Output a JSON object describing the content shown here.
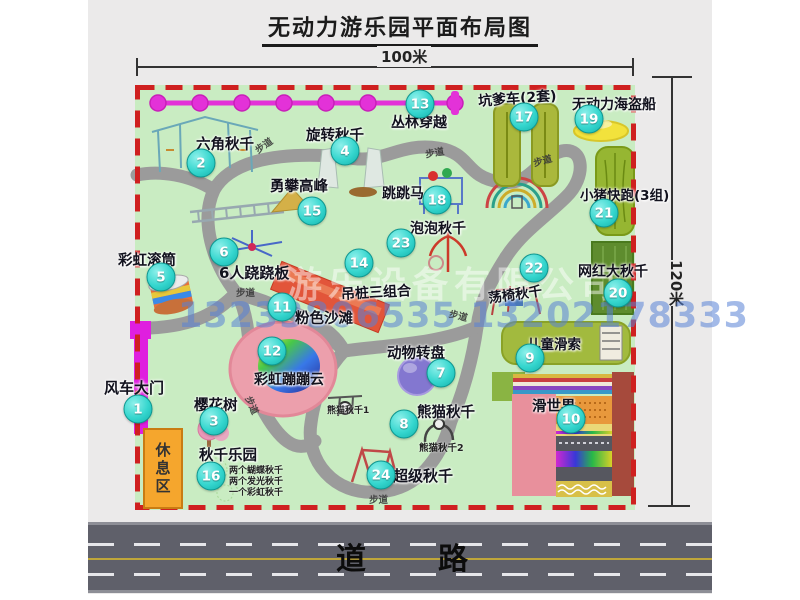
{
  "title": "无动力游乐园平面布局图",
  "dims": {
    "width": "100米",
    "height": "120米"
  },
  "road_label": "道路",
  "rest_area_label": "休息区",
  "watermark": {
    "company": "游乐设备有限公司",
    "phone": "13233806535 13202178333"
  },
  "notes": {
    "footpath": "步道",
    "panda1": "熊猫秋千1",
    "panda2": "熊猫秋千2",
    "swing_notes": [
      "两个蝴蝶秋千",
      "两个发光秋千",
      "一个彩虹秋千"
    ]
  },
  "attractions": [
    {
      "num": "1",
      "label": "风车大门"
    },
    {
      "num": "2",
      "label": "六角秋千"
    },
    {
      "num": "3",
      "label": "樱花树"
    },
    {
      "num": "4",
      "label": "旋转秋千"
    },
    {
      "num": "5",
      "label": "彩虹滚筒"
    },
    {
      "num": "6",
      "label": "6人跷跷板"
    },
    {
      "num": "7",
      "label": "动物转盘"
    },
    {
      "num": "8",
      "label": "熊猫秋千"
    },
    {
      "num": "9",
      "label": "儿童滑索"
    },
    {
      "num": "10",
      "label": "滑世界"
    },
    {
      "num": "11",
      "label": "粉色沙滩"
    },
    {
      "num": "12",
      "label": "彩虹蹦蹦云"
    },
    {
      "num": "13",
      "label": "丛林穿越"
    },
    {
      "num": "14",
      "label": "吊桩三组合"
    },
    {
      "num": "15",
      "label": "勇攀高峰"
    },
    {
      "num": "16",
      "label": "秋千乐园"
    },
    {
      "num": "17",
      "label": "坑爹车(2套)"
    },
    {
      "num": "18",
      "label": "跳跳马"
    },
    {
      "num": "19",
      "label": "无动力海盗船"
    },
    {
      "num": "20",
      "label": "网红大秋千"
    },
    {
      "num": "21",
      "label": "小猪快跑(3组)"
    },
    {
      "num": "22",
      "label": "荡椅秋千"
    },
    {
      "num": "23",
      "label": "泡泡秋千"
    },
    {
      "num": "24",
      "label": "超级秋千"
    }
  ],
  "colors": {
    "park_green": "#c9ecc2",
    "border_red": "#cf2020",
    "path_gray": "#9b9b9b",
    "badge_teal": "#2fd0c8",
    "zipline_magenta": "#e332d8",
    "gate_magenta": "#df1fdf",
    "rest_orange": "#f5a62d",
    "road_gray": "#5f606a"
  }
}
